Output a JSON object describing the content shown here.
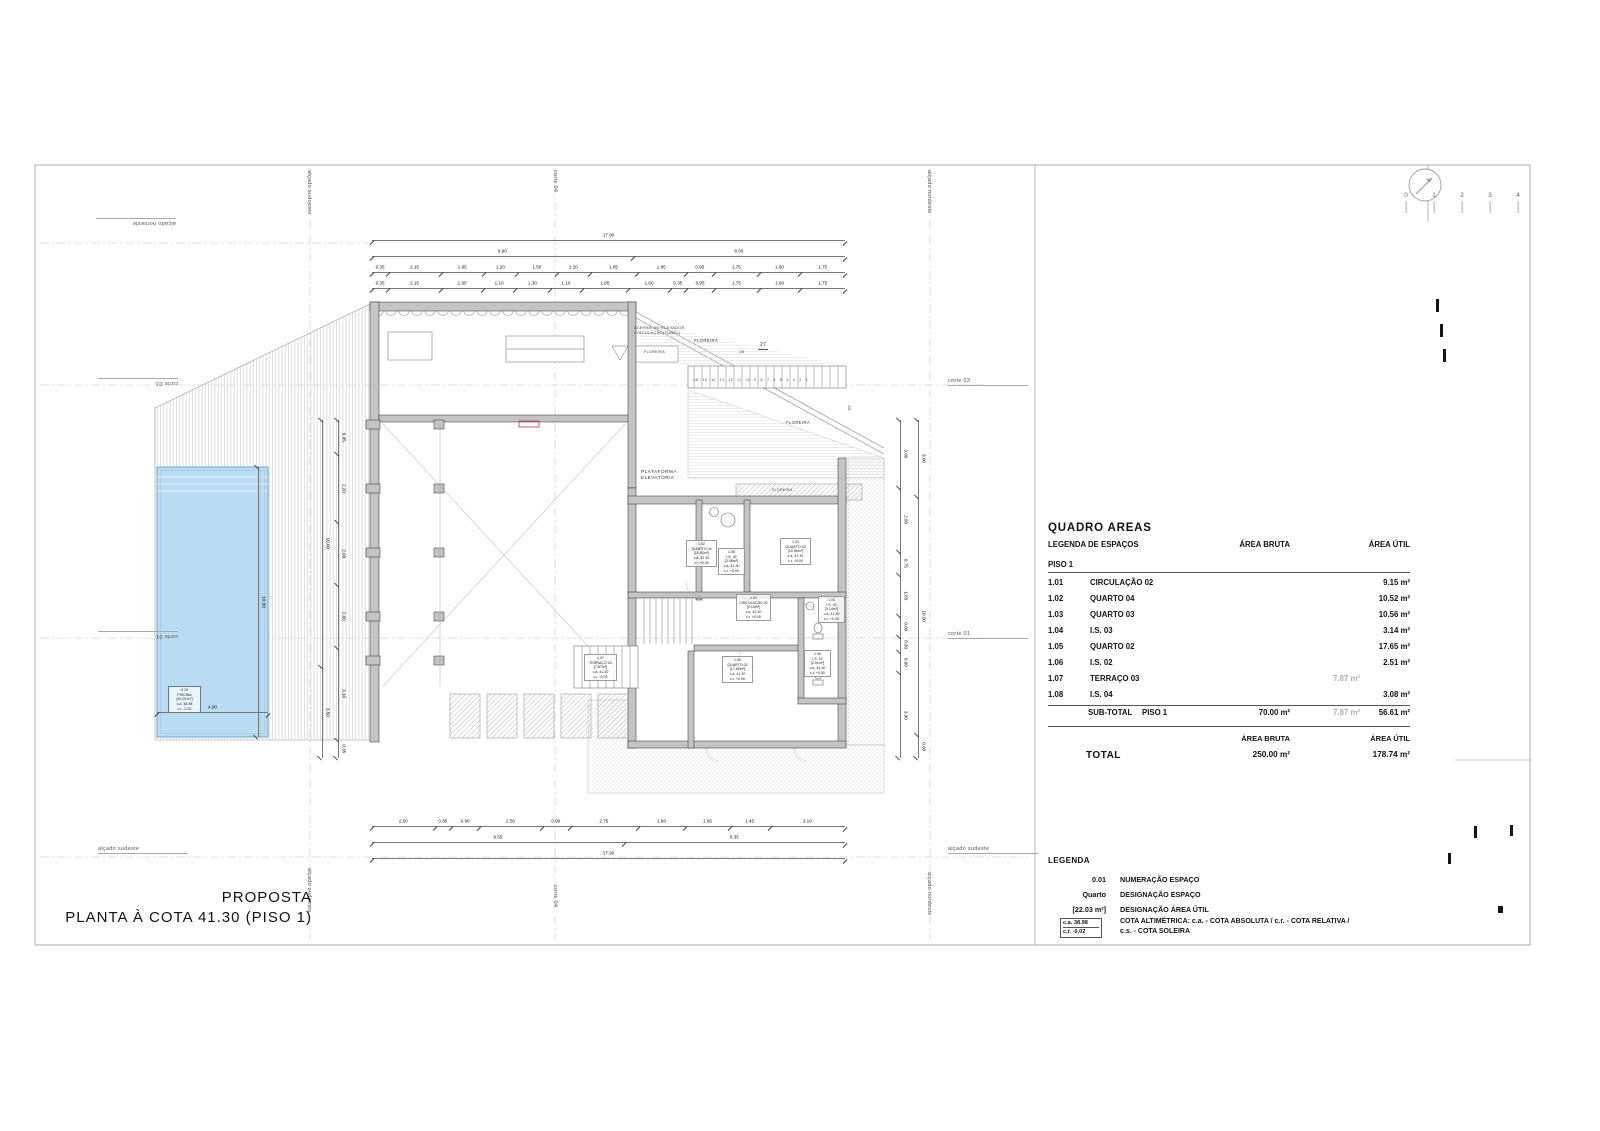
{
  "sheet": {
    "title_line1": "PROPOSTA",
    "title_line2": "PLANTA À COTA 41.30 (PISO 1)"
  },
  "colors": {
    "pool_fill": "#b9dcf3",
    "pool_edge": "#6fa8d2",
    "wall_fill": "#c4c4c4",
    "accent_red": "#cc3344",
    "muted_value": "#b0b0b0"
  },
  "scale_bar": {
    "labels": [
      "0",
      "1",
      "2",
      "3",
      "4"
    ]
  },
  "edge_labels": {
    "noroeste": "alçado noroeste",
    "nordeste": "alçado nordeste",
    "sudoeste": "alçado sudoeste",
    "sudeste": "alçado sudeste",
    "corte01": "corte 01",
    "corte03": "corte 03",
    "corte04": "corte 04"
  },
  "plan": {
    "floreira": "FLOREIRA",
    "plataforma": "PLATAFORMA\nELEVATÓRIA",
    "acesso": "ACESSO AO ELEVADOR\nCIRCULAÇÃO(TÚNEL)",
    "stair_numbers": "16 15 14 13 12 11 10 9 8 7 6 5 4 3 2 1",
    "stair_risers": "27",
    "tread": ".25",
    "rooms": {
      "r101": "1.01\nCIRCULAÇÃO 02\n[9.15m²]\nc.a. 41.30\nc.r. +0.00",
      "r102": "1.02\nQUARTO 04\n[10.52m²]\nc.a. 41.30\nc.r. +0.00",
      "r103": "1.03\nQUARTO 03\n[10.56m²]\nc.a. 41.30\nc.r. +0.00",
      "r104": "1.04\nI.S. 03\n[3.14m²]\nc.a. 41.30\nc.r. +0.00",
      "r105": "1.05\nQUARTO 02\n[17.65m²]\nc.a. 41.30\nc.r. +0.00",
      "r106": "1.06\nI.S. 02\n[2.51m²]\nc.a. 41.30\nc.r. +0.00",
      "r107": "1.07\nTERRAÇO 03\n[7.87m²]\nc.a. 41.30\nc.r. -0.02",
      "r108": "1.08\nI.S. 04\n[3.08m²]\nc.a. 41.30\nc.r. +0.00",
      "piscina": "0.19\nPISCINA\n[40.00 m²]\nc.a. 38.98\nc.r. -2.32"
    },
    "dims": {
      "top1": [
        "17.90"
      ],
      "top2": [
        "9.90",
        "8.00"
      ],
      "top3": [
        "0.35",
        "2.15",
        "1.65",
        "1.20",
        "1.50",
        "1.20",
        "1.85",
        "1.95",
        "0.95",
        "1.75",
        "1.60",
        "1.75"
      ],
      "top4": [
        "0.35",
        "2.15",
        "1.65",
        "1.10",
        "1.30",
        "1.10",
        "1.85",
        "1.60",
        "0.35",
        "0.95",
        "1.75",
        "1.60",
        "1.75"
      ],
      "bottom1": [
        "2.50",
        "0.35",
        "0.90",
        "2.50",
        "0.90",
        "2.75",
        "1.80",
        "1.65",
        "1.45",
        "3.10"
      ],
      "bottom2": [
        "9.55",
        "8.35"
      ],
      "bottom3": [
        "17.90"
      ],
      "right_inner": [
        "3.00",
        "2.80",
        "0.75",
        "1.65",
        "0.60",
        "0.30",
        "0.60",
        "3.90"
      ],
      "right_outer": [
        "3.00",
        "10.00",
        "0.60"
      ],
      "left_inner": [
        "0.95",
        "2.20",
        "2.00",
        "2.00",
        "3.10",
        "0.35"
      ],
      "left_outer": [
        "10.00",
        "3.50"
      ],
      "pool_w": [
        "4.00"
      ],
      "pool_h": [
        "10.00"
      ]
    }
  },
  "areas_table": {
    "title": "QUADRO AREAS",
    "col_espacos": "LEGENDA DE ESPAÇOS",
    "col_bruta": "ÁREA BRUTA",
    "col_util": "ÁREA ÚTIL",
    "floor": "PISO 1",
    "rows": [
      {
        "num": "1.01",
        "label": "CIRCULAÇÃO 02",
        "bruta": "",
        "gray": "",
        "util": "9.15 m²"
      },
      {
        "num": "1.02",
        "label": "QUARTO 04",
        "bruta": "",
        "gray": "",
        "util": "10.52 m²"
      },
      {
        "num": "1.03",
        "label": "QUARTO 03",
        "bruta": "",
        "gray": "",
        "util": "10.56 m²"
      },
      {
        "num": "1.04",
        "label": "I.S. 03",
        "bruta": "",
        "gray": "",
        "util": "3.14 m²"
      },
      {
        "num": "1.05",
        "label": "QUARTO 02",
        "bruta": "",
        "gray": "",
        "util": "17.65 m²"
      },
      {
        "num": "1.06",
        "label": "I.S. 02",
        "bruta": "",
        "gray": "",
        "util": "2.51 m²"
      },
      {
        "num": "1.07",
        "label": "TERRAÇO 03",
        "bruta": "",
        "gray": "7.87 m²",
        "util": ""
      },
      {
        "num": "1.08",
        "label": "I.S. 04",
        "bruta": "",
        "gray": "",
        "util": "3.08 m²"
      }
    ],
    "subtotal": {
      "label": "SUB-TOTAL",
      "floor": "PISO 1",
      "bruta": "70.00 m²",
      "gray": "7.87 m²",
      "util": "56.61 m²"
    },
    "total": {
      "label": "TOTAL",
      "bruta": "250.00 m²",
      "util": "178.74 m²"
    }
  },
  "legend": {
    "title": "LEGENDA",
    "rows": [
      {
        "key": "0.01",
        "desc": "NUMERAÇÃO ESPAÇO"
      },
      {
        "key": "Quarto",
        "desc": "DESIGNAÇÃO ESPAÇO"
      },
      {
        "key": "[22.03 m²]",
        "desc": "DESIGNAÇÃO ÁREA ÚTIL"
      }
    ],
    "cota_box": {
      "line1": "c.a. 38.98",
      "line2": "c.r. -0.02"
    },
    "cota_desc": "COTA ALTIMÉTRICA: c.a. - COTA ABSOLUTA / c.r. - COTA RELATIVA /\nc.s. - COTA SOLEIRA"
  }
}
